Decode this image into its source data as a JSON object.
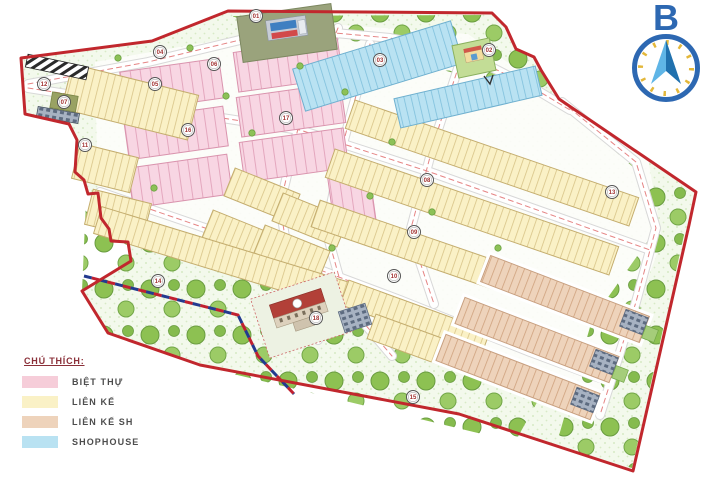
{
  "title": "Master plan map",
  "legend": {
    "title": "CHÚ THÍCH:",
    "items": [
      {
        "label": "BIỆT THỰ",
        "color": "#f6cdd9",
        "meaning": "villa"
      },
      {
        "label": "LIÊN KẾ",
        "color": "#faf1c6",
        "meaning": "townhouse"
      },
      {
        "label": "LIÊN KẾ SH",
        "color": "#eed3bb",
        "meaning": "townhouse-sh"
      },
      {
        "label": "SHOPHOUSE",
        "color": "#b9e2f2",
        "meaning": "shophouse"
      }
    ]
  },
  "compass": {
    "label": "B",
    "direction": "north"
  },
  "map": {
    "boundary_color": "#c1272d",
    "badges": [
      "01",
      "02",
      "03",
      "04",
      "05",
      "06",
      "07",
      "08",
      "09",
      "10",
      "11",
      "12",
      "13",
      "14",
      "15",
      "16",
      "17",
      "18"
    ],
    "colors": {
      "park_ground": "#f3f9ec",
      "tree": "#8dc152",
      "road": "#ffffff",
      "road_centerline": "#e58484",
      "villa_block": "#f8d6e3",
      "townhouse_block": "#faf1c6",
      "townhouse_sh_block": "#eed3bb",
      "shophouse_block": "#b9e2f2",
      "compass_blue": "#2d68b2",
      "compass_tick": "#e3b73a"
    }
  }
}
